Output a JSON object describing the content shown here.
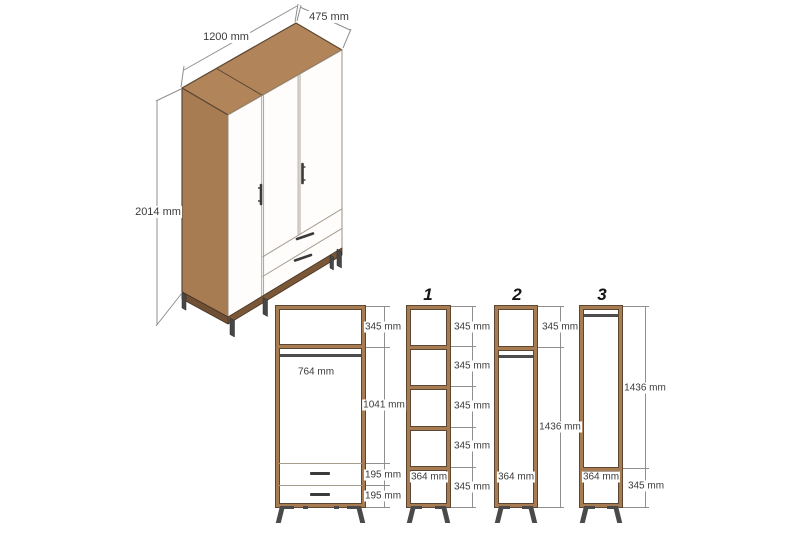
{
  "colors": {
    "walnut": "#a87c52",
    "walnut-top": "#b28459",
    "walnut-dark": "#5c4632",
    "base-dark": "#7a5837",
    "metal": "#4a4a4a",
    "dim-line": "#8f8f8f",
    "panel-edge": "#a59c8e",
    "text": "#3b3b3b"
  },
  "iso": {
    "width_label": "1200 mm",
    "depth_label": "475 mm",
    "height_label": "2014 mm"
  },
  "main_view": {
    "top_compartment_label": "345 mm",
    "rod_width_label": "764 mm",
    "hanging_section_label": "1041 mm",
    "drawer1_label": "195 mm",
    "drawer2_label": "195 mm"
  },
  "option1": {
    "number": "1",
    "cell_labels": [
      "345 mm",
      "345 mm",
      "345 mm",
      "345 mm",
      "345 mm"
    ],
    "width_label": "364 mm"
  },
  "option2": {
    "number": "2",
    "top_label": "345 mm",
    "tall_label": "1436 mm",
    "width_label": "364 mm"
  },
  "option3": {
    "number": "3",
    "tall_label": "1436 mm",
    "bottom_label": "345 mm",
    "width_label": "364 mm"
  }
}
